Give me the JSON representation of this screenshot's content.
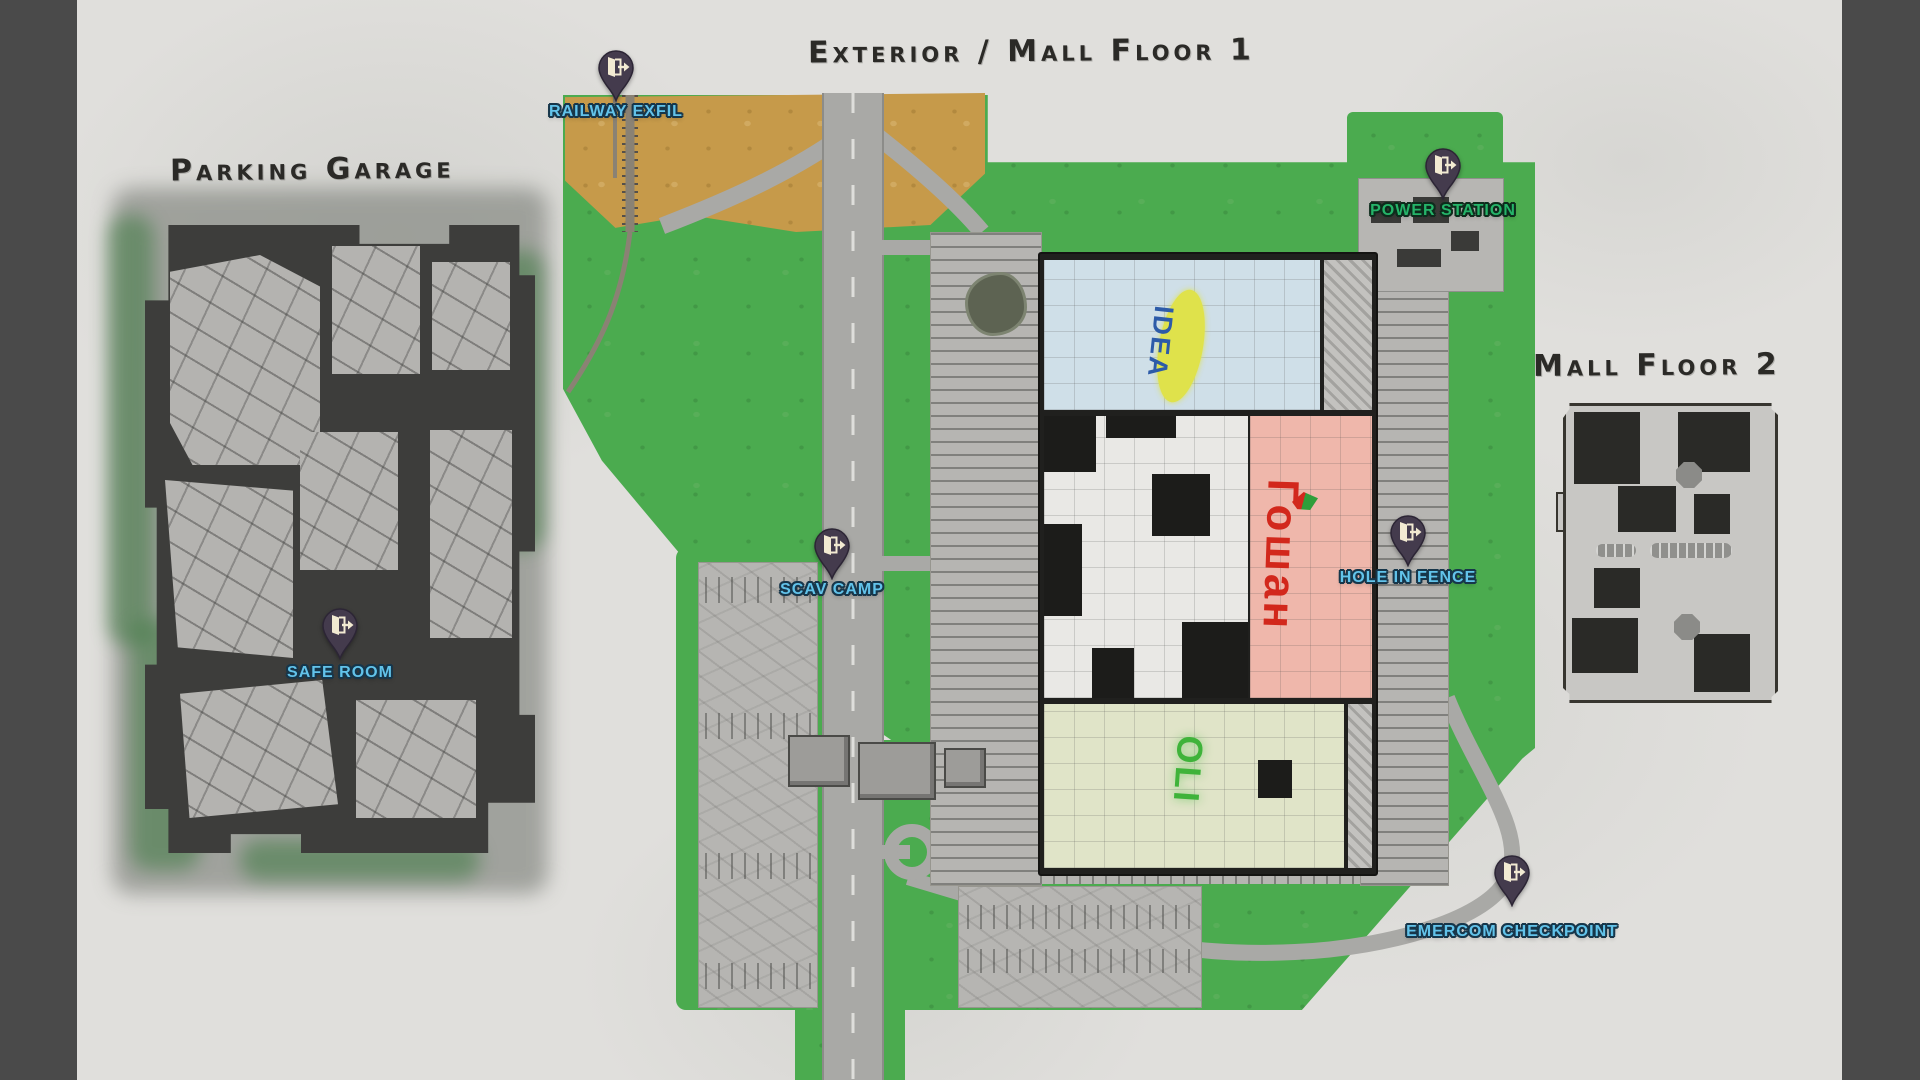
{
  "map_name": "Interchange",
  "titles": {
    "parking_garage": "Parking Garage",
    "exterior": "Exterior / Mall Floor 1",
    "mall_floor_2": "Mall Floor 2"
  },
  "markers": [
    {
      "id": "railway-exfil",
      "label": "RAILWAY EXFIL",
      "type": "extraction",
      "label_color": "#62c3ea"
    },
    {
      "id": "power-station",
      "label": "POWER STATION",
      "type": "extraction",
      "label_color": "#25b469"
    },
    {
      "id": "scav-camp",
      "label": "SCAV CAMP",
      "type": "extraction",
      "label_color": "#62c3ea"
    },
    {
      "id": "hole-in-fence",
      "label": "HOLE IN FENCE",
      "type": "extraction",
      "label_color": "#62c3ea"
    },
    {
      "id": "safe-room",
      "label": "SAFE ROOM",
      "type": "extraction",
      "label_color": "#62c3ea"
    },
    {
      "id": "emercom-checkpoint",
      "label": "EMERCOM CHECKPOINT",
      "type": "extraction",
      "label_color": "#62c3ea"
    }
  ],
  "stores": [
    {
      "id": "idea",
      "label": "IDEA",
      "text_color": "#2d5ba8",
      "badge_color": "#dfe24b",
      "area_color": "#cfdfe8"
    },
    {
      "id": "goshan",
      "label": "Гошан",
      "text_color": "#d2281c",
      "area_color": "#efb7ab"
    },
    {
      "id": "oli",
      "label": "OLI",
      "text_color": "#3fb33a",
      "area_color": "#e0e4c8"
    }
  ],
  "icons": {
    "marker_pin": "door-exit-icon"
  },
  "colors": {
    "paper": "#e0dfdc",
    "frame_bars": "#4a4a4a",
    "title_text": "#2b2a27",
    "pin_body": "#443b4d",
    "pin_glyph": "#f2ead2",
    "grass": "#4bab4f",
    "dirt": "#c69a4a",
    "road": "#a9a9a6",
    "garage_dark": "#3d3d3b",
    "garage_floor": "#b4b3b0"
  }
}
